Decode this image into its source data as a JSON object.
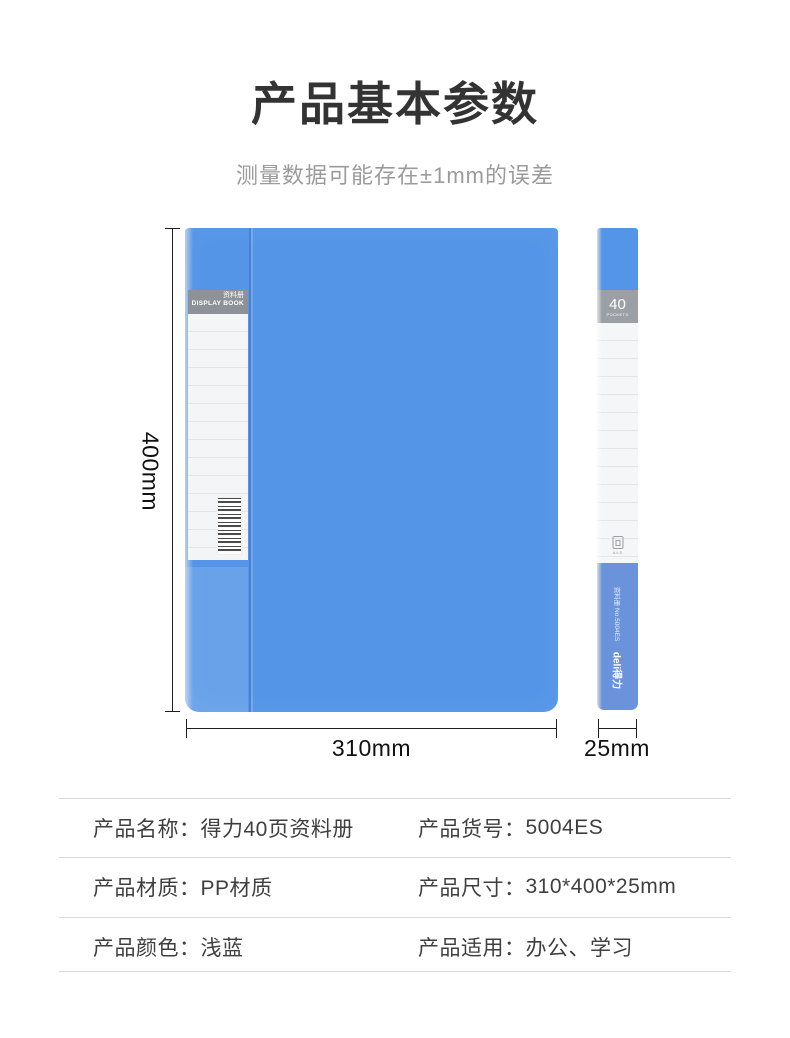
{
  "page": {
    "title": "产品基本参数",
    "subtitle": "测量数据可能存在±1mm的误差"
  },
  "colors": {
    "cover_blue": "#5495e7",
    "side_bottom_blue": "#6a93dc",
    "band_gray": "#8d9298",
    "title_dark": "#333333",
    "subtitle_gray": "#9b9b9b",
    "table_text": "#3f3f3f",
    "divider_gray": "#d9d9d9"
  },
  "front_view": {
    "spine_label_cn": "资料册",
    "spine_label_en": "DISPLAY BOOK"
  },
  "side_view": {
    "pocket_count": "40",
    "pocket_label": "POCKETS",
    "size_icon_label": "A4-S",
    "model_text": "资料册 No.5004ES",
    "brand_logo": "deli得力"
  },
  "dimensions": {
    "height_label": "400mm",
    "width_label": "310mm",
    "depth_label": "25mm"
  },
  "spec_table": {
    "rows": [
      [
        {
          "label": "产品名称：",
          "value": "得力40页资料册"
        },
        {
          "label": "产品货号：",
          "value": "5004ES"
        }
      ],
      [
        {
          "label": "产品材质：",
          "value": "PP材质"
        },
        {
          "label": "产品尺寸：",
          "value": "310*400*25mm"
        }
      ],
      [
        {
          "label": "产品颜色：",
          "value": "浅蓝"
        },
        {
          "label": "产品适用：",
          "value": "办公、学习"
        }
      ]
    ]
  }
}
